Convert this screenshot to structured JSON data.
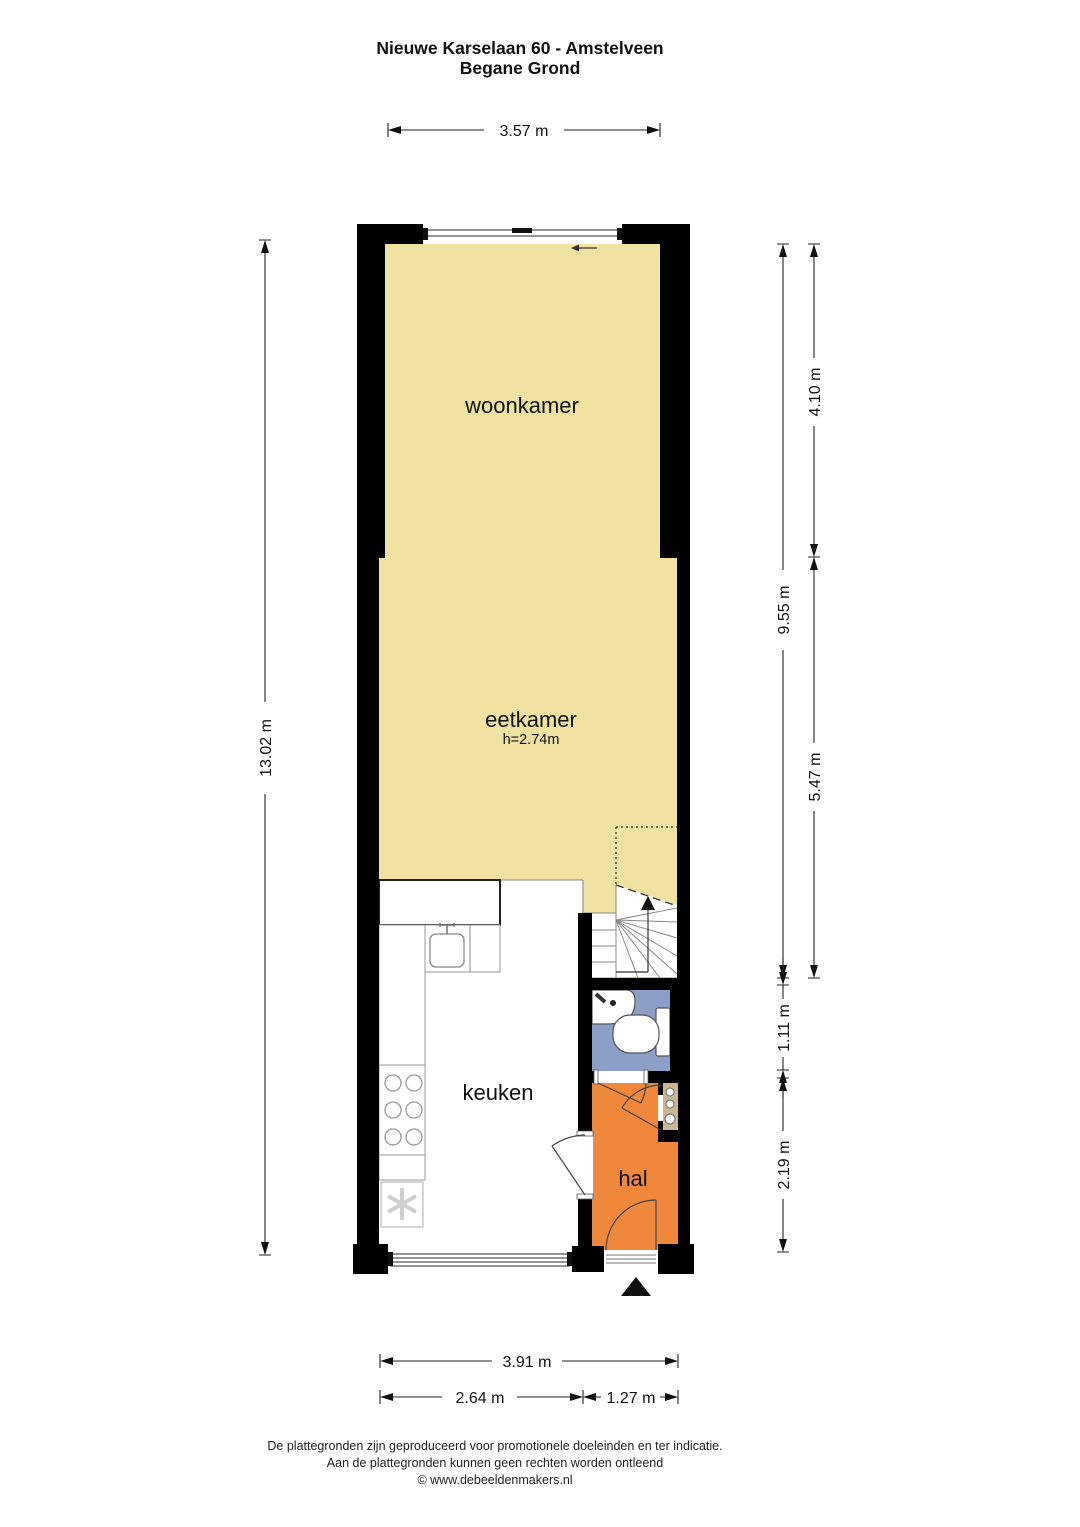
{
  "title": {
    "line1": "Nieuwe Karselaan 60 - Amstelveen",
    "line2": "Begane Grond"
  },
  "rooms": {
    "woonkamer": {
      "label": "woonkamer"
    },
    "eetkamer": {
      "label": "eetkamer",
      "ceiling_height": "h=2.74m"
    },
    "keuken": {
      "label": "keuken"
    },
    "hal": {
      "label": "hal"
    }
  },
  "dimensions": {
    "woonkamer_width": "3.57 m",
    "total_depth": "13.02 m",
    "living_depth": "9.55 m",
    "woonkamer_depth": "4.10 m",
    "eetkamer_depth": "5.47 m",
    "toilet_depth": "1.11 m",
    "hal_depth": "2.19 m",
    "total_width": "3.91 m",
    "keuken_width": "2.64 m",
    "hal_width": "1.27 m"
  },
  "footer": {
    "line1": "De plattegronden zijn geproduceerd voor promotionele doeleinden en ter indicatie.",
    "line2": "Aan de plattegronden kunnen geen rechten worden ontleend",
    "line3": "© www.debeeldenmakers.nl"
  },
  "colors": {
    "wall": "#000000",
    "floor_yellow": "#F0E2A0",
    "floor_orange": "#F0883B",
    "floor_blue": "#8C9FC7",
    "cupboard_tan": "#C9B795"
  }
}
